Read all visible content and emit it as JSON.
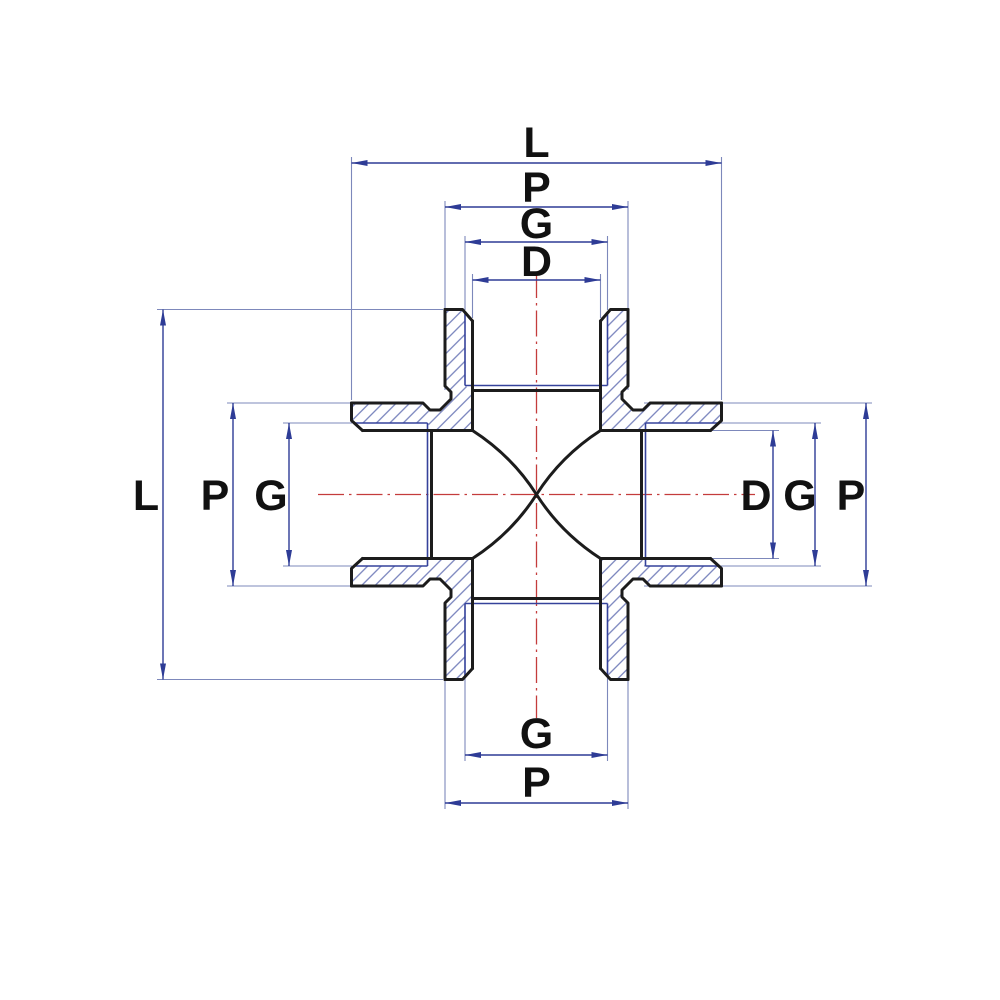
{
  "drawing": {
    "kind": "technical-section-drawing",
    "subject": "four-way cross pipe fitting, sectioned, with female threaded sockets",
    "dimension_labels": {
      "top": [
        "L",
        "P",
        "G",
        "D"
      ],
      "left": [
        "L",
        "P",
        "G"
      ],
      "right": [
        "D",
        "G",
        "P"
      ],
      "bottom": [
        "G",
        "P"
      ]
    },
    "colors": {
      "background": "#ffffff",
      "outline": "#1c1c1c",
      "thread": "#35429b",
      "extension": "#7d88bb",
      "dimension": "#2e3c96",
      "hatch": "#6e7ab8",
      "centerline": "#c43c3c",
      "label": "#111111"
    }
  }
}
